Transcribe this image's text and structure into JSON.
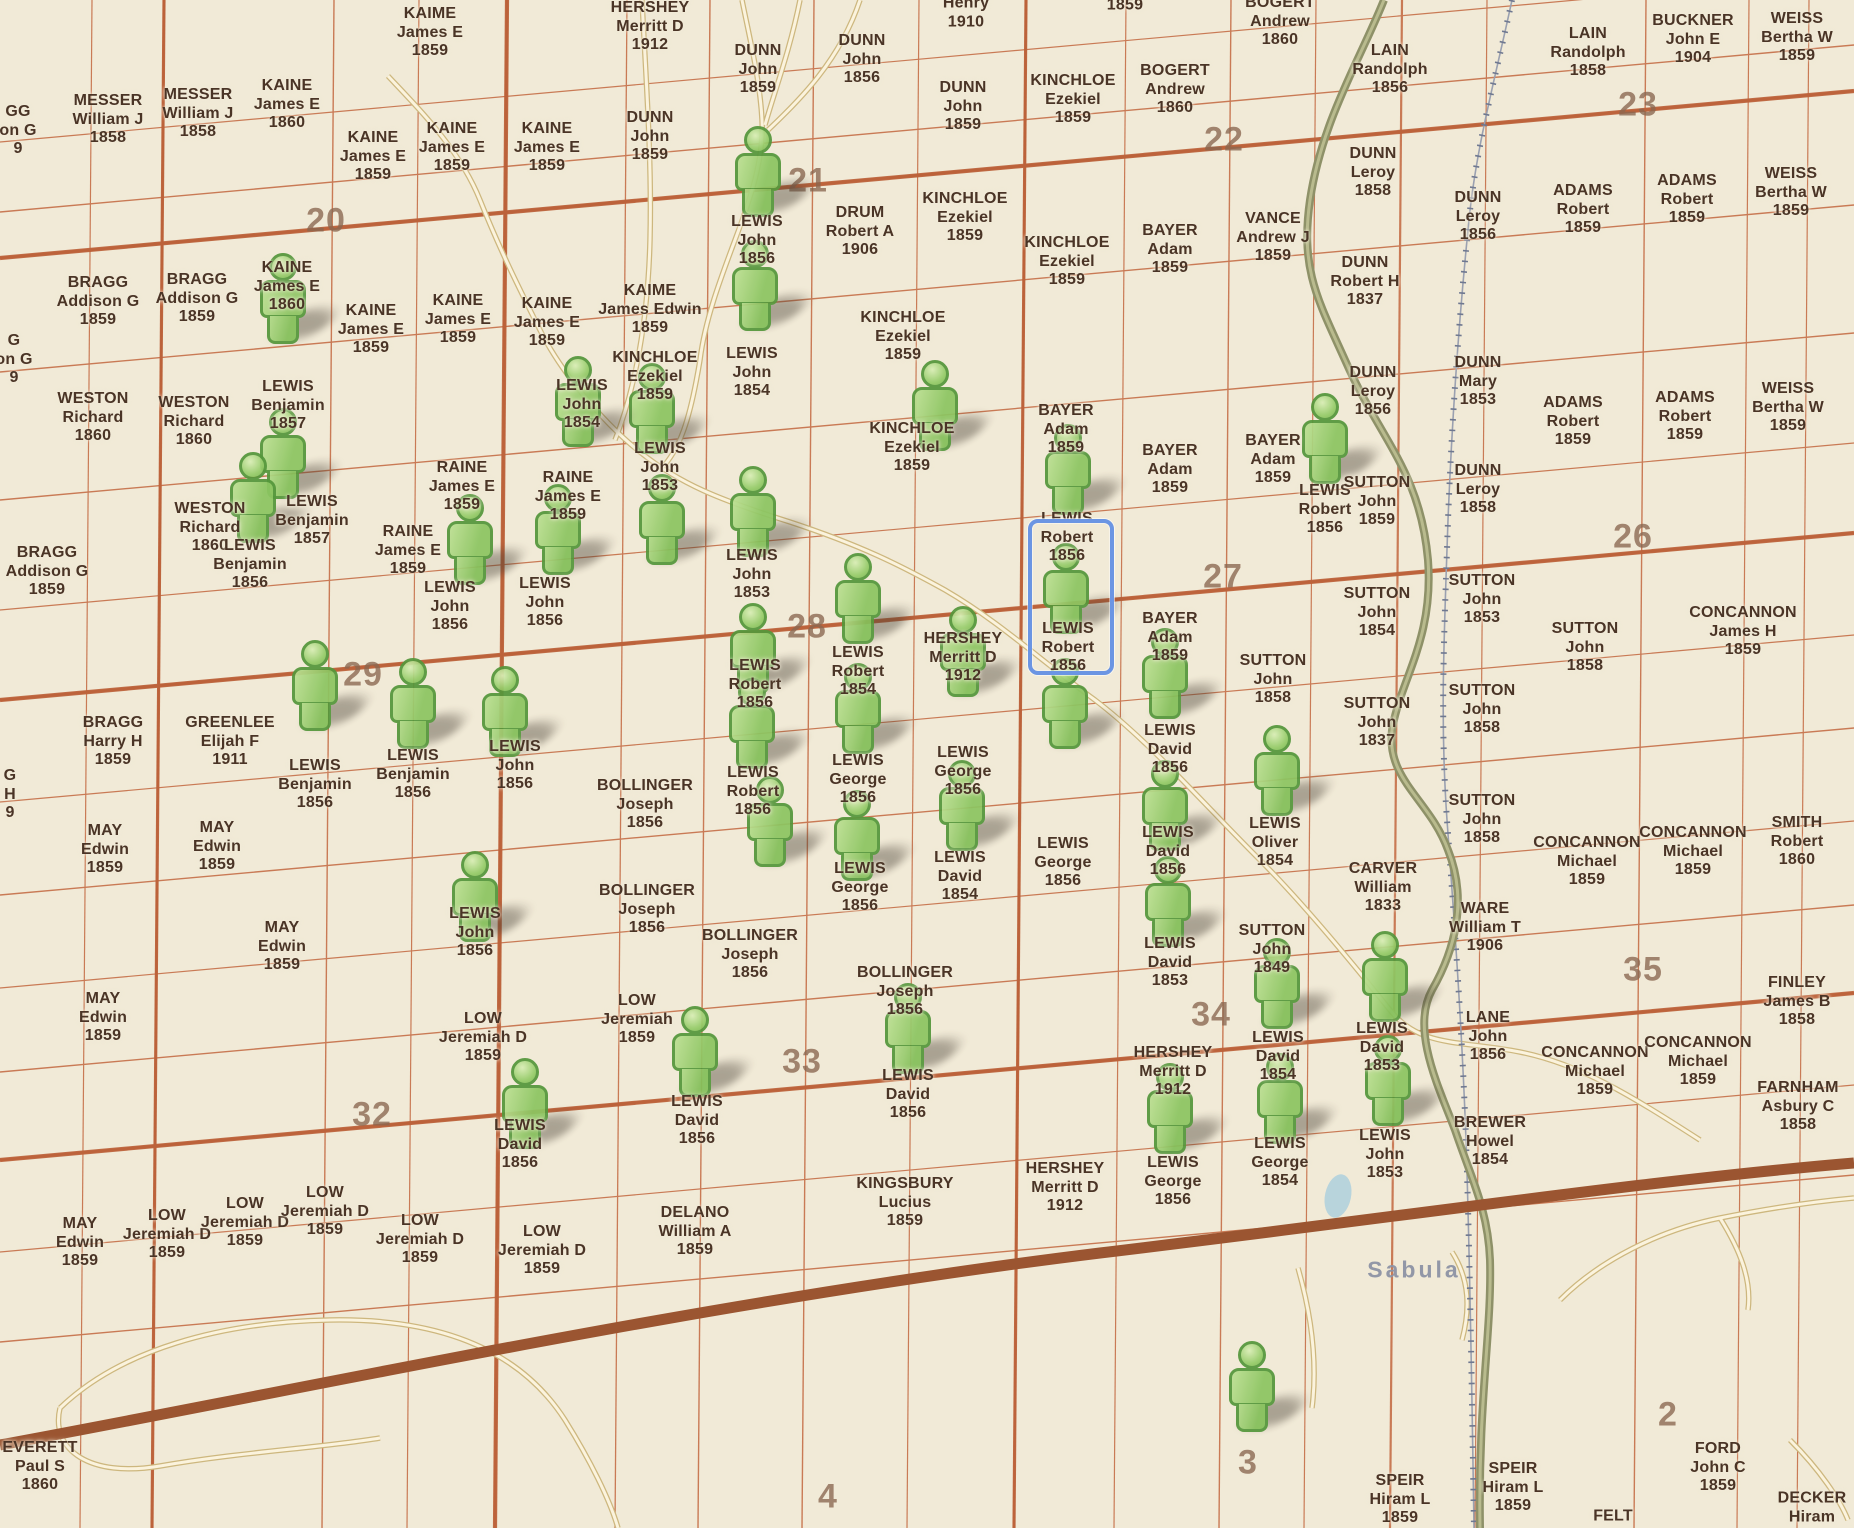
{
  "map": {
    "town_label": "Sabula",
    "colors": {
      "background": "#f1ead7",
      "parcel_text": "#4a3426",
      "section_number_text": "#8a6750",
      "marker_green": "#8cc561",
      "marker_border_green": "#55973c",
      "selection_blue": "#6b95e3",
      "grid_line_orange": "#c97a55",
      "major_road_brown": "#9b5531",
      "highway_olive": "#8e9168",
      "railroad_gray": "#6f7890",
      "minor_road_cream": "#fbf3dd",
      "town_text": "#8d93a5"
    },
    "selection": {
      "x": 1028,
      "y": 519,
      "w": 78,
      "h": 148
    },
    "section_numbers": [
      {
        "n": "20",
        "x": 326,
        "y": 221
      },
      {
        "n": "21",
        "x": 808,
        "y": 181
      },
      {
        "n": "22",
        "x": 1224,
        "y": 140
      },
      {
        "n": "23",
        "x": 1638,
        "y": 105
      },
      {
        "n": "26",
        "x": 1633,
        "y": 537
      },
      {
        "n": "27",
        "x": 1223,
        "y": 577
      },
      {
        "n": "28",
        "x": 807,
        "y": 627
      },
      {
        "n": "29",
        "x": 363,
        "y": 675
      },
      {
        "n": "32",
        "x": 372,
        "y": 1115
      },
      {
        "n": "33",
        "x": 802,
        "y": 1062
      },
      {
        "n": "34",
        "x": 1211,
        "y": 1015
      },
      {
        "n": "35",
        "x": 1643,
        "y": 970
      },
      {
        "n": "2",
        "x": 1668,
        "y": 1415
      },
      {
        "n": "3",
        "x": 1248,
        "y": 1463
      },
      {
        "n": "4",
        "x": 828,
        "y": 1497
      }
    ],
    "parcel_labels": [
      {
        "x": 18,
        "y": 131,
        "t": "GG|on G|9"
      },
      {
        "x": 14,
        "y": 360,
        "t": "G|on G|9"
      },
      {
        "x": 10,
        "y": 795,
        "t": "G|H|9"
      },
      {
        "x": 108,
        "y": 120,
        "t": "MESSER|William J|1858"
      },
      {
        "x": 198,
        "y": 114,
        "t": "MESSER|William J|1858"
      },
      {
        "x": 287,
        "y": 105,
        "t": "KAINE|James E|1860"
      },
      {
        "x": 430,
        "y": 33,
        "t": "KAIME|James E|1859"
      },
      {
        "x": 373,
        "y": 157,
        "t": "KAINE|James E|1859"
      },
      {
        "x": 452,
        "y": 148,
        "t": "KAINE|James E|1859"
      },
      {
        "x": 547,
        "y": 148,
        "t": "KAINE|James E|1859"
      },
      {
        "x": 650,
        "y": 27,
        "t": "HERSHEY|Merritt D|1912"
      },
      {
        "x": 650,
        "y": 137,
        "t": "DUNN|John|1859"
      },
      {
        "x": 758,
        "y": 70,
        "t": "DUNN|John|1859"
      },
      {
        "x": 862,
        "y": 60,
        "t": "DUNN|John|1856"
      },
      {
        "x": 966,
        "y": 13,
        "t": "Henry|1910"
      },
      {
        "x": 963,
        "y": 107,
        "t": "DUNN|John|1859"
      },
      {
        "x": 1125,
        "y": 6,
        "t": "1859"
      },
      {
        "x": 1073,
        "y": 100,
        "t": "KINCHLOE|Ezekiel|1859"
      },
      {
        "x": 1175,
        "y": 90,
        "t": "BOGERT|Andrew|1860"
      },
      {
        "x": 1280,
        "y": 22,
        "t": "BOGERT|Andrew|1860"
      },
      {
        "x": 1390,
        "y": 70,
        "t": "LAIN|Randolph|1856"
      },
      {
        "x": 1588,
        "y": 53,
        "t": "LAIN|Randolph|1858"
      },
      {
        "x": 1693,
        "y": 40,
        "t": "BUCKNER|John E|1904"
      },
      {
        "x": 1797,
        "y": 38,
        "t": "WEISS|Bertha W|1859"
      },
      {
        "x": 98,
        "y": 302,
        "t": "BRAGG|Addison G|1859"
      },
      {
        "x": 197,
        "y": 299,
        "t": "BRAGG|Addison G|1859"
      },
      {
        "x": 287,
        "y": 287,
        "t": "KAINE|James E|1860"
      },
      {
        "x": 371,
        "y": 330,
        "t": "KAINE|James E|1859"
      },
      {
        "x": 458,
        "y": 320,
        "t": "KAINE|James E|1859"
      },
      {
        "x": 650,
        "y": 310,
        "t": "KAIME|James Edwin|1859"
      },
      {
        "x": 547,
        "y": 323,
        "t": "KAINE|James E|1859"
      },
      {
        "x": 757,
        "y": 241,
        "t": "LEWIS|John|1856"
      },
      {
        "x": 860,
        "y": 232,
        "t": "DRUM|Robert A|1906"
      },
      {
        "x": 965,
        "y": 218,
        "t": "KINCHLOE|Ezekiel|1859"
      },
      {
        "x": 1170,
        "y": 250,
        "t": "BAYER|Adam|1859"
      },
      {
        "x": 1273,
        "y": 238,
        "t": "VANCE|Andrew J|1859"
      },
      {
        "x": 1067,
        "y": 262,
        "t": "KINCHLOE|Ezekiel|1859"
      },
      {
        "x": 1373,
        "y": 173,
        "t": "DUNN|Leroy|1858"
      },
      {
        "x": 1478,
        "y": 217,
        "t": "DUNN|Leroy|1856"
      },
      {
        "x": 1583,
        "y": 210,
        "t": "ADAMS|Robert|1859"
      },
      {
        "x": 1687,
        "y": 200,
        "t": "ADAMS|Robert|1859"
      },
      {
        "x": 1791,
        "y": 193,
        "t": "WEISS|Bertha W|1859"
      },
      {
        "x": 1365,
        "y": 282,
        "t": "DUNN|Robert H|1837"
      },
      {
        "x": 93,
        "y": 418,
        "t": "WESTON|Richard|1860"
      },
      {
        "x": 194,
        "y": 422,
        "t": "WESTON|Richard|1860"
      },
      {
        "x": 288,
        "y": 406,
        "t": "LEWIS|Benjamin|1857"
      },
      {
        "x": 752,
        "y": 373,
        "t": "LEWIS|John|1854"
      },
      {
        "x": 903,
        "y": 337,
        "t": "KINCHLOE|Ezekiel|1859"
      },
      {
        "x": 210,
        "y": 528,
        "t": "WESTON|Richard|1860"
      },
      {
        "x": 312,
        "y": 521,
        "t": "LEWIS|Benjamin|1857"
      },
      {
        "x": 47,
        "y": 572,
        "t": "BRAGG|Addison G|1859"
      },
      {
        "x": 250,
        "y": 565,
        "t": "LEWIS|Benjamin|1856"
      },
      {
        "x": 462,
        "y": 487,
        "t": "RAINE|James E|1859"
      },
      {
        "x": 408,
        "y": 551,
        "t": "RAINE|James E|1859"
      },
      {
        "x": 568,
        "y": 497,
        "t": "RAINE|James E|1859"
      },
      {
        "x": 545,
        "y": 603,
        "t": "LEWIS|John|1856"
      },
      {
        "x": 450,
        "y": 607,
        "t": "LEWIS|John|1856"
      },
      {
        "x": 582,
        "y": 405,
        "t": "LEWIS|John|1854"
      },
      {
        "x": 655,
        "y": 377,
        "t": "KINCHLOE|Ezekiel|1859"
      },
      {
        "x": 660,
        "y": 468,
        "t": "LEWIS|John|1853"
      },
      {
        "x": 752,
        "y": 575,
        "t": "LEWIS|John|1853"
      },
      {
        "x": 912,
        "y": 448,
        "t": "KINCHLOE|Ezekiel|1859"
      },
      {
        "x": 1066,
        "y": 430,
        "t": "BAYER|Adam|1859"
      },
      {
        "x": 1170,
        "y": 470,
        "t": "BAYER|Adam|1859"
      },
      {
        "x": 1273,
        "y": 460,
        "t": "BAYER|Adam|1859"
      },
      {
        "x": 1067,
        "y": 538,
        "t": "LEWIS|Robert|1856"
      },
      {
        "x": 1068,
        "y": 648,
        "t": "LEWIS|Robert|1856"
      },
      {
        "x": 1373,
        "y": 392,
        "t": "DUNN|Leroy|1856"
      },
      {
        "x": 1478,
        "y": 382,
        "t": "DUNN|Mary|1853"
      },
      {
        "x": 1325,
        "y": 510,
        "t": "LEWIS|Robert|1856"
      },
      {
        "x": 1377,
        "y": 502,
        "t": "SUTTON|John|1859"
      },
      {
        "x": 1478,
        "y": 490,
        "t": "DUNN|Leroy|1858"
      },
      {
        "x": 755,
        "y": 685,
        "t": "LEWIS|Robert|1856"
      },
      {
        "x": 753,
        "y": 792,
        "t": "LEWIS|Robert|1856"
      },
      {
        "x": 858,
        "y": 672,
        "t": "LEWIS|Robert|1854"
      },
      {
        "x": 858,
        "y": 780,
        "t": "LEWIS|George|1856"
      },
      {
        "x": 860,
        "y": 888,
        "t": "LEWIS|George|1856"
      },
      {
        "x": 963,
        "y": 658,
        "t": "HERSHEY|Merritt D|1912"
      },
      {
        "x": 963,
        "y": 772,
        "t": "LEWIS|George|1856"
      },
      {
        "x": 960,
        "y": 877,
        "t": "LEWIS|David|1854"
      },
      {
        "x": 1063,
        "y": 863,
        "t": "LEWIS|George|1856"
      },
      {
        "x": 1170,
        "y": 638,
        "t": "BAYER|Adam|1859"
      },
      {
        "x": 1170,
        "y": 750,
        "t": "LEWIS|David|1856"
      },
      {
        "x": 1168,
        "y": 852,
        "t": "LEWIS|David|1856"
      },
      {
        "x": 1170,
        "y": 963,
        "t": "LEWIS|David|1853"
      },
      {
        "x": 1272,
        "y": 950,
        "t": "SUTTON|John|1849"
      },
      {
        "x": 1278,
        "y": 1057,
        "t": "LEWIS|David|1854"
      },
      {
        "x": 1280,
        "y": 1163,
        "t": "LEWIS|George|1854"
      },
      {
        "x": 1275,
        "y": 843,
        "t": "LEWIS|Oliver|1854"
      },
      {
        "x": 1273,
        "y": 680,
        "t": "SUTTON|John|1858"
      },
      {
        "x": 1377,
        "y": 613,
        "t": "SUTTON|John|1854"
      },
      {
        "x": 1482,
        "y": 600,
        "t": "SUTTON|John|1853"
      },
      {
        "x": 1377,
        "y": 723,
        "t": "SUTTON|John|1837"
      },
      {
        "x": 1482,
        "y": 710,
        "t": "SUTTON|John|1858"
      },
      {
        "x": 1585,
        "y": 648,
        "t": "SUTTON|John|1858"
      },
      {
        "x": 1743,
        "y": 632,
        "t": "CONCANNON|James H|1859"
      },
      {
        "x": 1573,
        "y": 422,
        "t": "ADAMS|Robert|1859"
      },
      {
        "x": 1685,
        "y": 417,
        "t": "ADAMS|Robert|1859"
      },
      {
        "x": 1788,
        "y": 408,
        "t": "WEISS|Bertha W|1859"
      },
      {
        "x": 113,
        "y": 742,
        "t": "BRAGG|Harry H|1859"
      },
      {
        "x": 230,
        "y": 742,
        "t": "GREENLEE|Elijah F|1911"
      },
      {
        "x": 315,
        "y": 785,
        "t": "LEWIS|Benjamin|1856"
      },
      {
        "x": 413,
        "y": 775,
        "t": "LEWIS|Benjamin|1856"
      },
      {
        "x": 515,
        "y": 766,
        "t": "LEWIS|John|1856"
      },
      {
        "x": 105,
        "y": 850,
        "t": "MAY|Edwin|1859"
      },
      {
        "x": 217,
        "y": 847,
        "t": "MAY|Edwin|1859"
      },
      {
        "x": 282,
        "y": 947,
        "t": "MAY|Edwin|1859"
      },
      {
        "x": 103,
        "y": 1018,
        "t": "MAY|Edwin|1859"
      },
      {
        "x": 645,
        "y": 805,
        "t": "BOLLINGER|Joseph|1856"
      },
      {
        "x": 647,
        "y": 910,
        "t": "BOLLINGER|Joseph|1856"
      },
      {
        "x": 750,
        "y": 955,
        "t": "BOLLINGER|Joseph|1856"
      },
      {
        "x": 905,
        "y": 992,
        "t": "BOLLINGER|Joseph|1856"
      },
      {
        "x": 475,
        "y": 933,
        "t": "LEWIS|John|1856"
      },
      {
        "x": 483,
        "y": 1038,
        "t": "LOW|Jeremiah D|1859"
      },
      {
        "x": 637,
        "y": 1020,
        "t": "LOW|Jeremiah|1859"
      },
      {
        "x": 520,
        "y": 1145,
        "t": "LEWIS|David|1856"
      },
      {
        "x": 697,
        "y": 1121,
        "t": "LEWIS|David|1856"
      },
      {
        "x": 908,
        "y": 1095,
        "t": "LEWIS|David|1856"
      },
      {
        "x": 905,
        "y": 1203,
        "t": "KINGSBURY|Lucius|1859"
      },
      {
        "x": 695,
        "y": 1232,
        "t": "DELANO|William A|1859"
      },
      {
        "x": 80,
        "y": 1243,
        "t": "MAY|Edwin|1859"
      },
      {
        "x": 167,
        "y": 1235,
        "t": "LOW|Jeremiah D|1859"
      },
      {
        "x": 245,
        "y": 1223,
        "t": "LOW|Jeremiah D|1859"
      },
      {
        "x": 325,
        "y": 1212,
        "t": "LOW|Jeremiah D|1859"
      },
      {
        "x": 420,
        "y": 1240,
        "t": "LOW|Jeremiah D|1859"
      },
      {
        "x": 542,
        "y": 1251,
        "t": "LOW|Jeremiah D|1859"
      },
      {
        "x": 1173,
        "y": 1072,
        "t": "HERSHEY|Merritt D|1912"
      },
      {
        "x": 1173,
        "y": 1182,
        "t": "LEWIS|George|1856"
      },
      {
        "x": 1065,
        "y": 1188,
        "t": "HERSHEY|Merritt D|1912"
      },
      {
        "x": 1383,
        "y": 888,
        "t": "CARVER|William|1833"
      },
      {
        "x": 1485,
        "y": 928,
        "t": "WARE|William T|1906"
      },
      {
        "x": 1482,
        "y": 820,
        "t": "SUTTON|John|1858"
      },
      {
        "x": 1587,
        "y": 862,
        "t": "CONCANNON|Michael|1859"
      },
      {
        "x": 1693,
        "y": 852,
        "t": "CONCANNON|Michael|1859"
      },
      {
        "x": 1797,
        "y": 842,
        "t": "SMITH|Robert|1860"
      },
      {
        "x": 1797,
        "y": 1002,
        "t": "FINLEY|James B|1858"
      },
      {
        "x": 1488,
        "y": 1037,
        "t": "LANE|John|1856"
      },
      {
        "x": 1595,
        "y": 1072,
        "t": "CONCANNON|Michael|1859"
      },
      {
        "x": 1698,
        "y": 1062,
        "t": "CONCANNON|Michael|1859"
      },
      {
        "x": 1798,
        "y": 1107,
        "t": "FARNHAM|Asbury C|1858"
      },
      {
        "x": 1382,
        "y": 1048,
        "t": "LEWIS|David|1853"
      },
      {
        "x": 1385,
        "y": 1155,
        "t": "LEWIS|John|1853"
      },
      {
        "x": 1490,
        "y": 1142,
        "t": "BREWER|Howel|1854"
      },
      {
        "x": 40,
        "y": 1467,
        "t": "EVERETT|Paul S|1860"
      },
      {
        "x": 1400,
        "y": 1500,
        "t": "SPEIR|Hiram L|1859"
      },
      {
        "x": 1513,
        "y": 1488,
        "t": "SPEIR|Hiram L|1859"
      },
      {
        "x": 1613,
        "y": 1517,
        "t": "FELT"
      },
      {
        "x": 1718,
        "y": 1468,
        "t": "FORD|John C|1859"
      },
      {
        "x": 1812,
        "y": 1508,
        "t": "DECKER|Hiram"
      }
    ],
    "person_markers": [
      {
        "x": 283,
        "y": 253
      },
      {
        "x": 283,
        "y": 408
      },
      {
        "x": 253,
        "y": 452
      },
      {
        "x": 315,
        "y": 640
      },
      {
        "x": 413,
        "y": 658
      },
      {
        "x": 505,
        "y": 666
      },
      {
        "x": 470,
        "y": 494
      },
      {
        "x": 558,
        "y": 484
      },
      {
        "x": 652,
        "y": 363
      },
      {
        "x": 662,
        "y": 474
      },
      {
        "x": 758,
        "y": 126
      },
      {
        "x": 755,
        "y": 240
      },
      {
        "x": 578,
        "y": 356
      },
      {
        "x": 935,
        "y": 360
      },
      {
        "x": 1068,
        "y": 424
      },
      {
        "x": 1066,
        "y": 543,
        "selected": true
      },
      {
        "x": 1065,
        "y": 658
      },
      {
        "x": 1165,
        "y": 628
      },
      {
        "x": 1165,
        "y": 760
      },
      {
        "x": 1168,
        "y": 856
      },
      {
        "x": 963,
        "y": 606
      },
      {
        "x": 962,
        "y": 760
      },
      {
        "x": 1277,
        "y": 725
      },
      {
        "x": 1277,
        "y": 938
      },
      {
        "x": 1280,
        "y": 1053
      },
      {
        "x": 1170,
        "y": 1063
      },
      {
        "x": 858,
        "y": 553
      },
      {
        "x": 858,
        "y": 663
      },
      {
        "x": 857,
        "y": 790
      },
      {
        "x": 753,
        "y": 466
      },
      {
        "x": 753,
        "y": 603
      },
      {
        "x": 752,
        "y": 678
      },
      {
        "x": 770,
        "y": 776
      },
      {
        "x": 695,
        "y": 1006
      },
      {
        "x": 908,
        "y": 983
      },
      {
        "x": 525,
        "y": 1058
      },
      {
        "x": 475,
        "y": 851
      },
      {
        "x": 1325,
        "y": 393
      },
      {
        "x": 1385,
        "y": 931
      },
      {
        "x": 1388,
        "y": 1035
      },
      {
        "x": 1252,
        "y": 1341
      }
    ]
  }
}
